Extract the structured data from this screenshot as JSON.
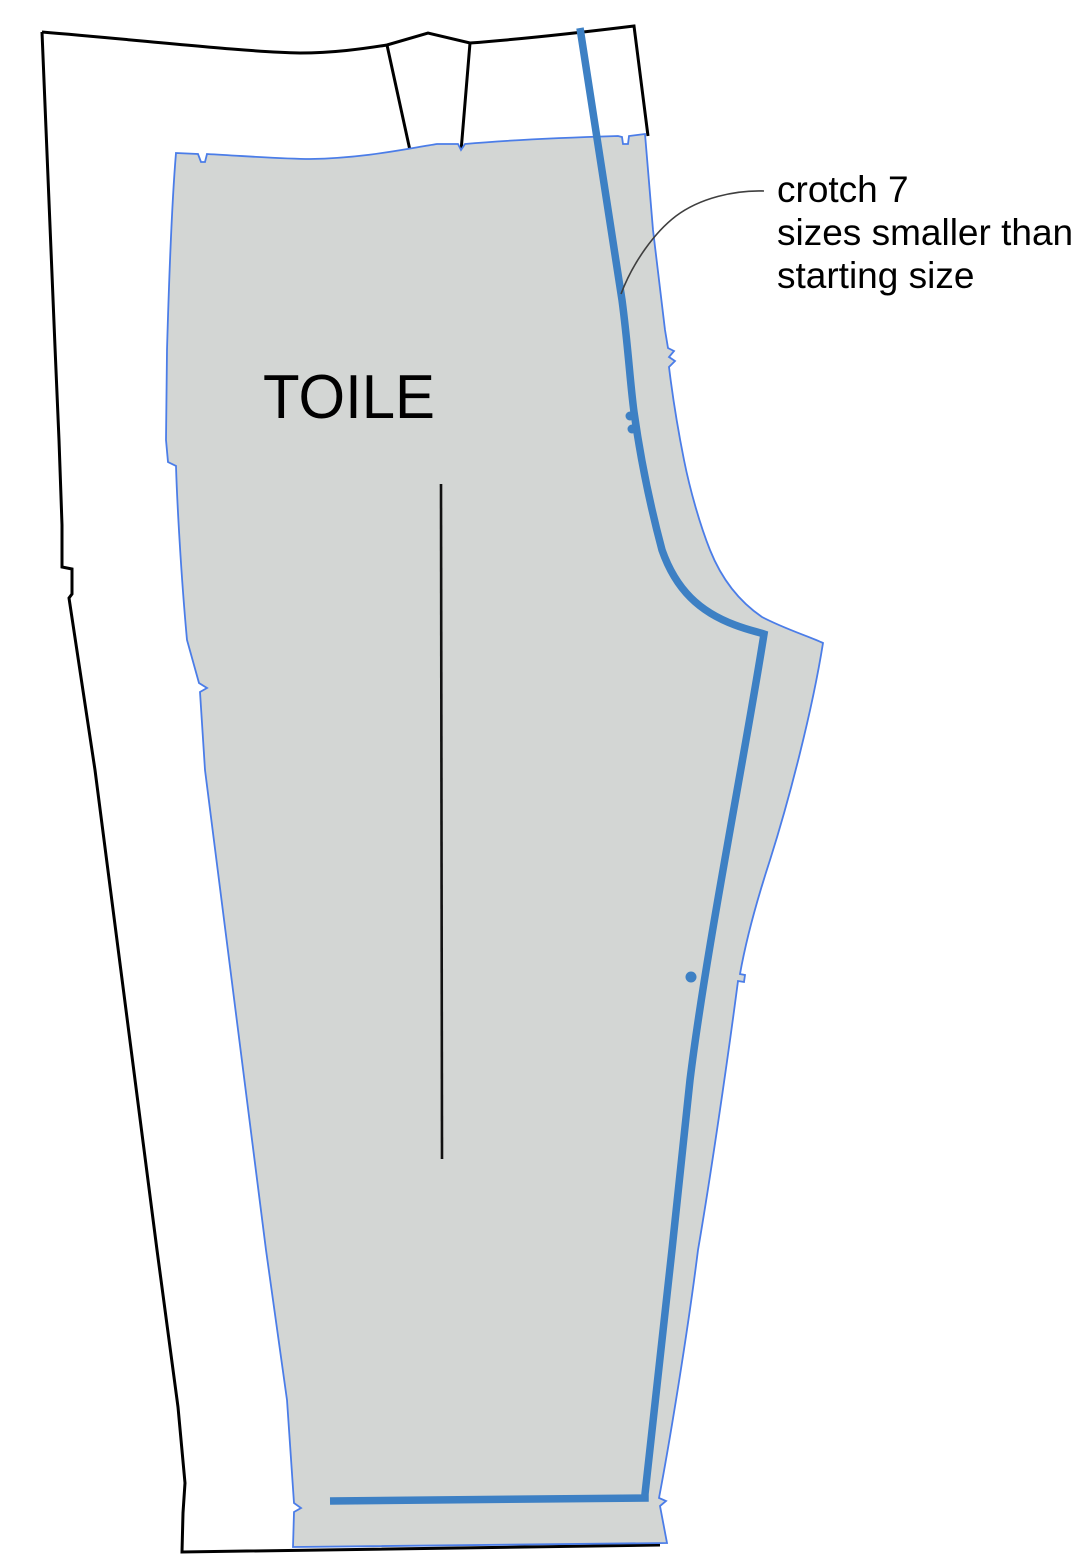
{
  "diagram": {
    "title": "pants pattern grading diagram",
    "toile_label": "TOILE",
    "annotation": {
      "line1": "crotch 7",
      "line2": "sizes smaller than",
      "line3": "starting size"
    },
    "colors": {
      "background": "#ffffff",
      "outer_pattern_outline": "#000000",
      "toile_fill": "#d3d6d4",
      "toile_outline": "#4b7de8",
      "crotch_line": "#3d80c4",
      "grain_line": "#111111",
      "leader_line": "#3f3f3f",
      "label_text": "#000000"
    }
  }
}
